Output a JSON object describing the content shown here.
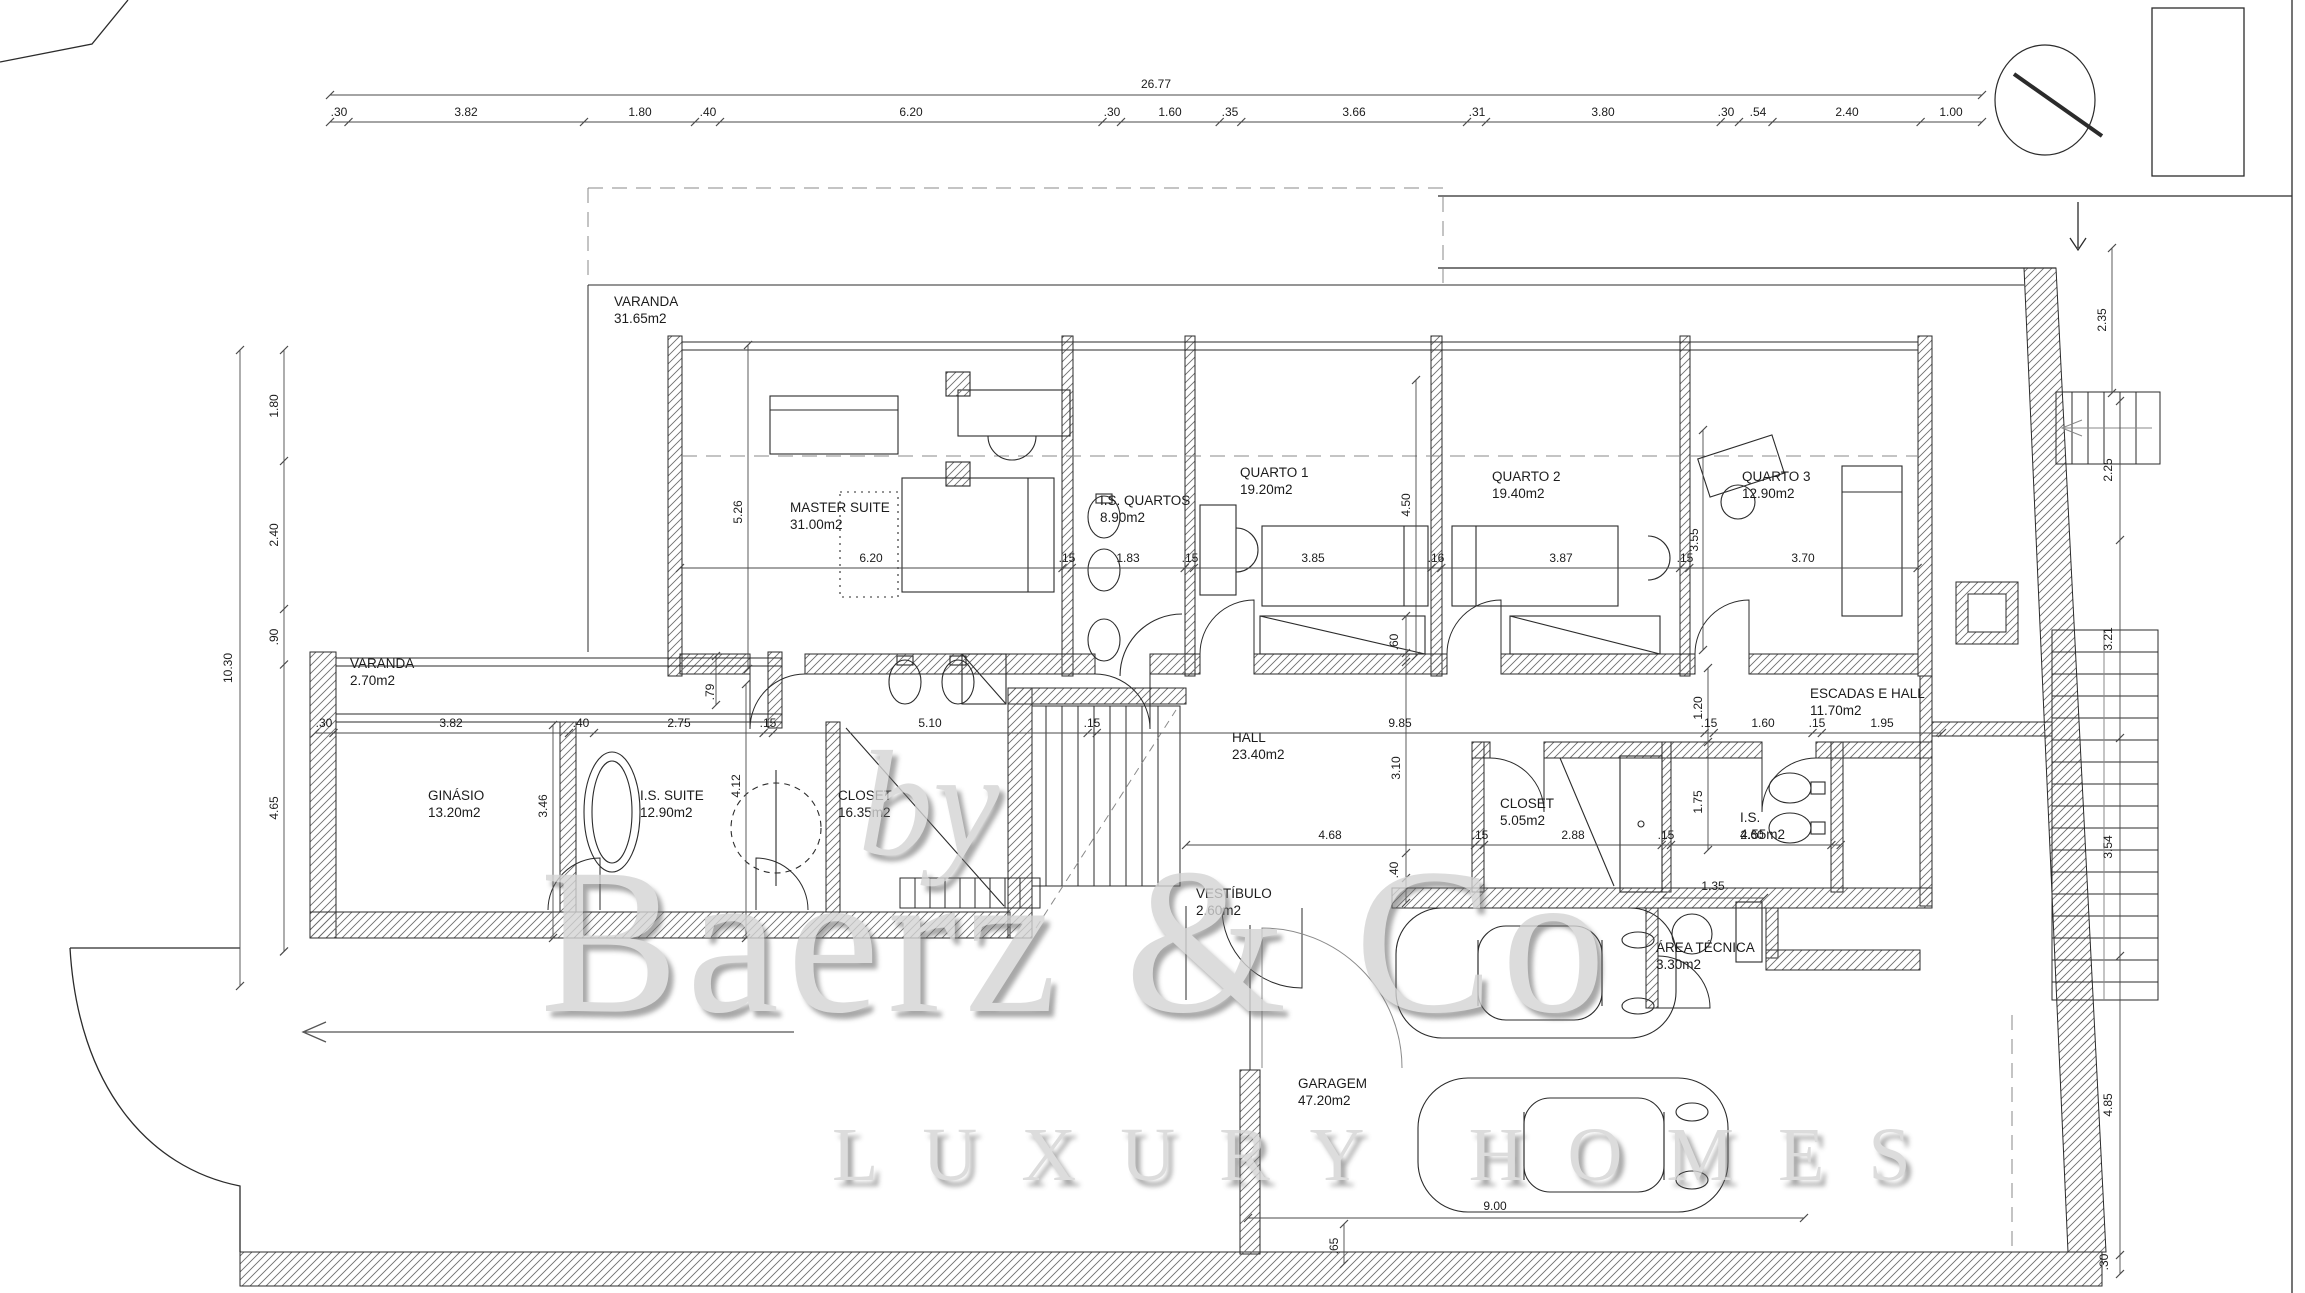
{
  "drawing": {
    "title": "floor plan",
    "watermark": {
      "by": "by",
      "brand": "Baerz & Co",
      "tagline": "LUXURY HOMES"
    },
    "colors": {
      "line": "#2b2b2b",
      "hatch": "#6e6e6e",
      "dim_line": "#4a4a4a",
      "text": "#1c1c1c",
      "watermark": "#d4d4d4"
    },
    "north_icon": "north-indicator-circle",
    "rooms": [
      {
        "name": "VARANDA",
        "area": "31.65m2",
        "x": 614,
        "y": 306
      },
      {
        "name": "MASTER SUITE",
        "area": "31.00m2",
        "x": 790,
        "y": 512
      },
      {
        "name": "I.S. QUARTOS",
        "area": "8.90m2",
        "x": 1100,
        "y": 505
      },
      {
        "name": "QUARTO 1",
        "area": "19.20m2",
        "x": 1240,
        "y": 477
      },
      {
        "name": "QUARTO 2",
        "area": "19.40m2",
        "x": 1492,
        "y": 481
      },
      {
        "name": "QUARTO 3",
        "area": "12.90m2",
        "x": 1742,
        "y": 481
      },
      {
        "name": "VARANDA",
        "area": "2.70m2",
        "x": 350,
        "y": 668
      },
      {
        "name": "GINÁSIO",
        "area": "13.20m2",
        "x": 428,
        "y": 800
      },
      {
        "name": "I.S. SUITE",
        "area": "12.90m2",
        "x": 640,
        "y": 800
      },
      {
        "name": "CLOSET",
        "area": "16.35m2",
        "x": 838,
        "y": 800
      },
      {
        "name": "HALL",
        "area": "23.40m2",
        "x": 1232,
        "y": 742
      },
      {
        "name": "CLOSET",
        "area": "5.05m2",
        "x": 1500,
        "y": 808
      },
      {
        "name": "I.S.",
        "area": "4.55m2",
        "x": 1740,
        "y": 822
      },
      {
        "name": "ESCADAS E HALL",
        "area": "11.70m2",
        "x": 1810,
        "y": 698
      },
      {
        "name": "VESTÍBULO",
        "area": "2.60m2",
        "x": 1196,
        "y": 898
      },
      {
        "name": "ÁREA TÉCNICA",
        "area": "3.30m2",
        "x": 1656,
        "y": 952
      },
      {
        "name": "GARAGEM",
        "area": "47.20m2",
        "x": 1298,
        "y": 1088
      }
    ],
    "dims": [
      {
        "v": "26.77",
        "x": 1156,
        "y": 88
      },
      {
        "v": ".30",
        "x": 339,
        "y": 116
      },
      {
        "v": "3.82",
        "x": 466,
        "y": 116
      },
      {
        "v": "1.80",
        "x": 640,
        "y": 116
      },
      {
        "v": ".40",
        "x": 708,
        "y": 116
      },
      {
        "v": "6.20",
        "x": 911,
        "y": 116
      },
      {
        "v": ".30",
        "x": 1112,
        "y": 116
      },
      {
        "v": "1.60",
        "x": 1170,
        "y": 116
      },
      {
        "v": ".35",
        "x": 1230,
        "y": 116
      },
      {
        "v": "3.66",
        "x": 1354,
        "y": 116
      },
      {
        "v": ".31",
        "x": 1477,
        "y": 116
      },
      {
        "v": "3.80",
        "x": 1603,
        "y": 116
      },
      {
        "v": ".30",
        "x": 1726,
        "y": 116
      },
      {
        "v": ".54",
        "x": 1758,
        "y": 116
      },
      {
        "v": "2.40",
        "x": 1847,
        "y": 116
      },
      {
        "v": "1.00",
        "x": 1951,
        "y": 116
      },
      {
        "v": "10.30",
        "x": 232,
        "y": 668,
        "rot": 1
      },
      {
        "v": "1.80",
        "x": 278,
        "y": 406,
        "rot": 1
      },
      {
        "v": "2.40",
        "x": 278,
        "y": 535,
        "rot": 1
      },
      {
        "v": ".90",
        "x": 278,
        "y": 637,
        "rot": 1
      },
      {
        "v": "4.65",
        "x": 278,
        "y": 808,
        "rot": 1
      },
      {
        "v": "2.35",
        "x": 2106,
        "y": 320,
        "rot": 1
      },
      {
        "v": "2.25",
        "x": 2112,
        "y": 470,
        "rot": 1
      },
      {
        "v": "3.21",
        "x": 2112,
        "y": 639,
        "rot": 1
      },
      {
        "v": "3.54",
        "x": 2112,
        "y": 847,
        "rot": 1
      },
      {
        "v": "4.85",
        "x": 2112,
        "y": 1105,
        "rot": 1
      },
      {
        "v": ".30",
        "x": 2108,
        "y": 1262,
        "rot": 1
      },
      {
        "v": "6.20",
        "x": 871,
        "y": 562
      },
      {
        "v": ".15",
        "x": 1067,
        "y": 562
      },
      {
        "v": "1.83",
        "x": 1128,
        "y": 562
      },
      {
        "v": ".15",
        "x": 1190,
        "y": 562
      },
      {
        "v": "3.85",
        "x": 1313,
        "y": 562
      },
      {
        "v": ".16",
        "x": 1436,
        "y": 562
      },
      {
        "v": "3.87",
        "x": 1561,
        "y": 562
      },
      {
        "v": ".15",
        "x": 1685,
        "y": 562
      },
      {
        "v": "3.70",
        "x": 1803,
        "y": 562
      },
      {
        "v": "5.26",
        "x": 742,
        "y": 512,
        "rot": 1
      },
      {
        "v": "4.50",
        "x": 1410,
        "y": 505,
        "rot": 1
      },
      {
        "v": "3.55",
        "x": 1698,
        "y": 540,
        "rot": 1
      },
      {
        "v": ".60",
        "x": 1398,
        "y": 642,
        "rot": 1
      },
      {
        "v": "3.10",
        "x": 1400,
        "y": 768,
        "rot": 1
      },
      {
        "v": "1.20",
        "x": 1702,
        "y": 708,
        "rot": 1
      },
      {
        "v": "1.75",
        "x": 1702,
        "y": 802,
        "rot": 1
      },
      {
        "v": ".79",
        "x": 714,
        "y": 692,
        "rot": 1
      },
      {
        "v": "3.46",
        "x": 547,
        "y": 806,
        "rot": 1
      },
      {
        "v": "4.12",
        "x": 740,
        "y": 786,
        "rot": 1
      },
      {
        "v": ".40",
        "x": 1398,
        "y": 870,
        "rot": 1
      },
      {
        "v": ".65",
        "x": 1338,
        "y": 1246,
        "rot": 1
      },
      {
        "v": ".30",
        "x": 324,
        "y": 727
      },
      {
        "v": "3.82",
        "x": 451,
        "y": 727
      },
      {
        "v": ".40",
        "x": 581,
        "y": 727
      },
      {
        "v": "2.75",
        "x": 679,
        "y": 727
      },
      {
        "v": ".15",
        "x": 768,
        "y": 727
      },
      {
        "v": "5.10",
        "x": 930,
        "y": 727
      },
      {
        "v": ".15",
        "x": 1092,
        "y": 727
      },
      {
        "v": "9.85",
        "x": 1400,
        "y": 727
      },
      {
        "v": ".15",
        "x": 1709,
        "y": 727
      },
      {
        "v": "1.60",
        "x": 1763,
        "y": 727
      },
      {
        "v": ".15",
        "x": 1817,
        "y": 727
      },
      {
        "v": "1.95",
        "x": 1882,
        "y": 727
      },
      {
        "v": "4.68",
        "x": 1330,
        "y": 839
      },
      {
        "v": ".15",
        "x": 1480,
        "y": 839
      },
      {
        "v": "2.88",
        "x": 1573,
        "y": 839
      },
      {
        "v": ".15",
        "x": 1666,
        "y": 839
      },
      {
        "v": "2.60",
        "x": 1752,
        "y": 839
      },
      {
        "v": "1.35",
        "x": 1713,
        "y": 890
      },
      {
        "v": "9.00",
        "x": 1495,
        "y": 1210
      }
    ]
  }
}
